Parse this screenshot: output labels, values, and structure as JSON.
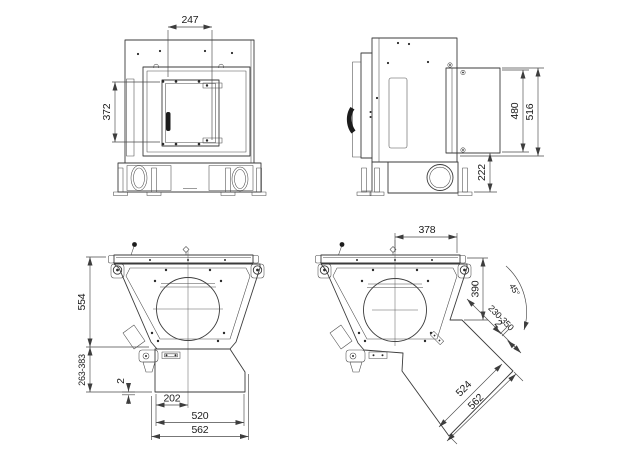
{
  "drawing": {
    "views": {
      "front": {
        "dims": {
          "opening_width": "247",
          "opening_height": "372"
        }
      },
      "side": {
        "dims": {
          "housing_inner_height": "480",
          "housing_outer_height": "516",
          "base_height": "222"
        }
      },
      "top_straight": {
        "dims": {
          "body_depth": "554",
          "duct_depth_range": "263-383",
          "flange_lip": "2",
          "duct_center_offset": "202",
          "duct_inner_width": "520",
          "duct_outer_width": "562"
        }
      },
      "top_rotated": {
        "dims": {
          "center_to_corner": "378",
          "corner_depth": "390",
          "duct_angle": "45°",
          "duct_depth_range": "230-350",
          "flange_lip": "2",
          "duct_inner_width": "524",
          "duct_outer_width": "562"
        }
      }
    }
  }
}
